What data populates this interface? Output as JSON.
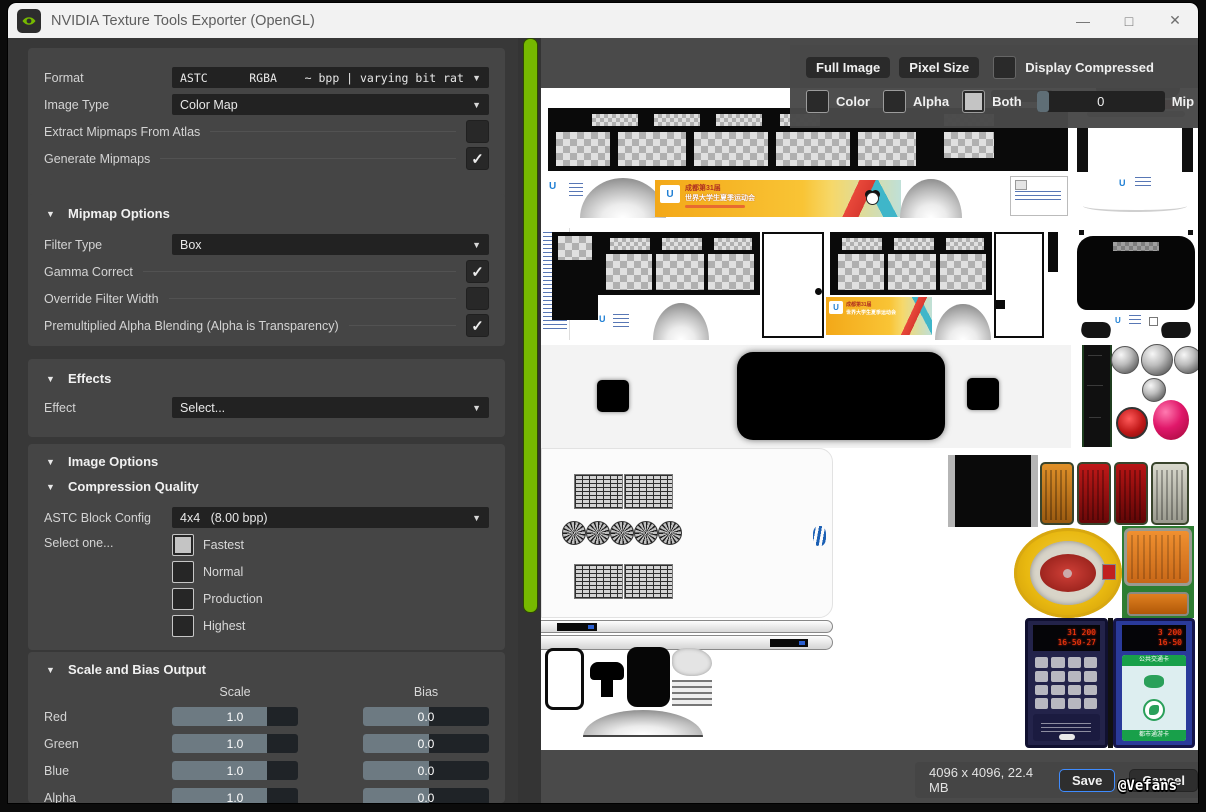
{
  "window": {
    "title": "NVIDIA Texture Tools Exporter (OpenGL)",
    "minimize": "—",
    "maximize": "□",
    "close": "✕"
  },
  "icons": {
    "triangle": "▼",
    "check": "✓"
  },
  "colors": {
    "nvidia_green": "#76b900",
    "save_accent": "#3f8cff"
  },
  "panel": {
    "format_label": "Format",
    "format_value": "ASTC      RGBA    ~ bpp | varying bit rat",
    "image_type_label": "Image Type",
    "image_type_value": "Color Map",
    "extract_label": "Extract Mipmaps From Atlas",
    "generate_label": "Generate Mipmaps",
    "mipmap": {
      "title": "Mipmap Options",
      "filter_label": "Filter Type",
      "filter_value": "Box",
      "gamma_label": "Gamma Correct",
      "override_label": "Override Filter Width",
      "premult_label": "Premultiplied Alpha Blending (Alpha is Transparency)"
    },
    "effects": {
      "title": "Effects",
      "effect_label": "Effect",
      "effect_value": "Select..."
    },
    "image_options": {
      "title": "Image Options",
      "cq_title": "Compression Quality",
      "astc_label": "ASTC Block Config",
      "astc_value": "4x4   (8.00 bpp)",
      "select_label": "Select one...",
      "options": [
        {
          "label": "Fastest",
          "selected": true
        },
        {
          "label": "Normal",
          "selected": false
        },
        {
          "label": "Production",
          "selected": false
        },
        {
          "label": "Highest",
          "selected": false
        }
      ]
    },
    "scale_bias": {
      "title": "Scale and Bias Output",
      "col_scale": "Scale",
      "col_bias": "Bias",
      "rows": [
        {
          "label": "Red",
          "scale": "1.0",
          "bias": "0.0"
        },
        {
          "label": "Green",
          "scale": "1.0",
          "bias": "0.0"
        },
        {
          "label": "Blue",
          "scale": "1.0",
          "bias": "0.0"
        },
        {
          "label": "Alpha",
          "scale": "1.0",
          "bias": "0.0"
        }
      ]
    }
  },
  "preview": {
    "full_image": "Full Image",
    "pixel_size": "Pixel Size",
    "display_compressed": "Display Compressed",
    "color": "Color",
    "alpha": "Alpha",
    "both": "Both",
    "mip_value": "0",
    "mip_label": "Mip",
    "size_info": "4096 x 4096, 22.4 MB",
    "save": "Save",
    "cancel": "Cancel",
    "watermark": "@Vefans"
  },
  "texture": {
    "logo_u": "U",
    "banner_line1": "成都第31届",
    "banner_line2": "世界大学生夏季运动会",
    "led_left_1": "31 200",
    "led_left_2": "16-50-27",
    "led_right_1": "3 200",
    "led_right_2": "16-50",
    "card_top": "公共交通卡",
    "card_bottom": "都市通游卡"
  }
}
